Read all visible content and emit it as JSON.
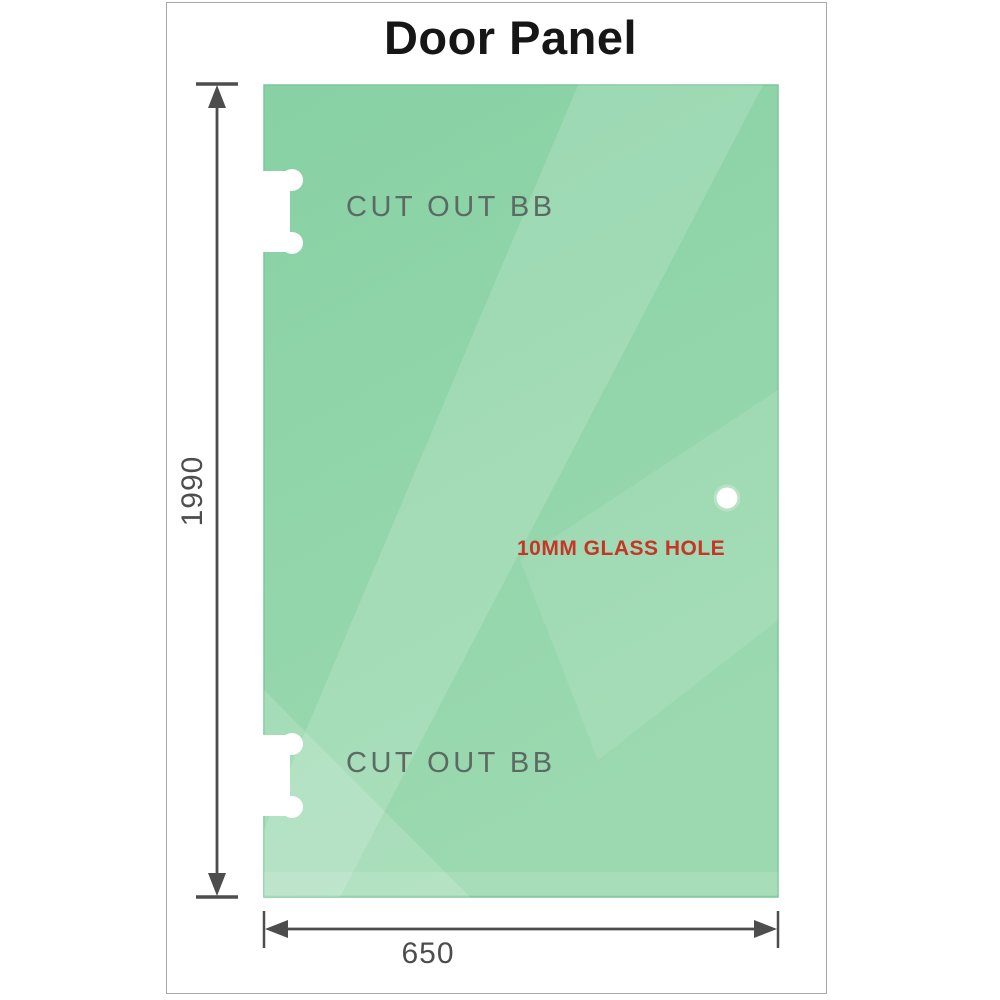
{
  "title": "Door Panel",
  "labels": {
    "top_cutout": "CUT OUT BB",
    "bottom_cutout": "CUT OUT BB",
    "glass_hole": "10MM GLASS HOLE"
  },
  "dimensions": {
    "height": "1990",
    "width": "650"
  },
  "colors": {
    "glass_base": "#87d1a4",
    "glass_base_light": "#9cd9b0",
    "glass_edge": "#7cc79a",
    "hole_ring": "#b7e2c4",
    "cutout_white": "#ffffff",
    "dimension_gray": "#4d4d4d",
    "label_gray": "#5c6a62",
    "hole_label_red": "#c63526",
    "title_color": "#161616",
    "frame_border": "#a8a8a8"
  }
}
